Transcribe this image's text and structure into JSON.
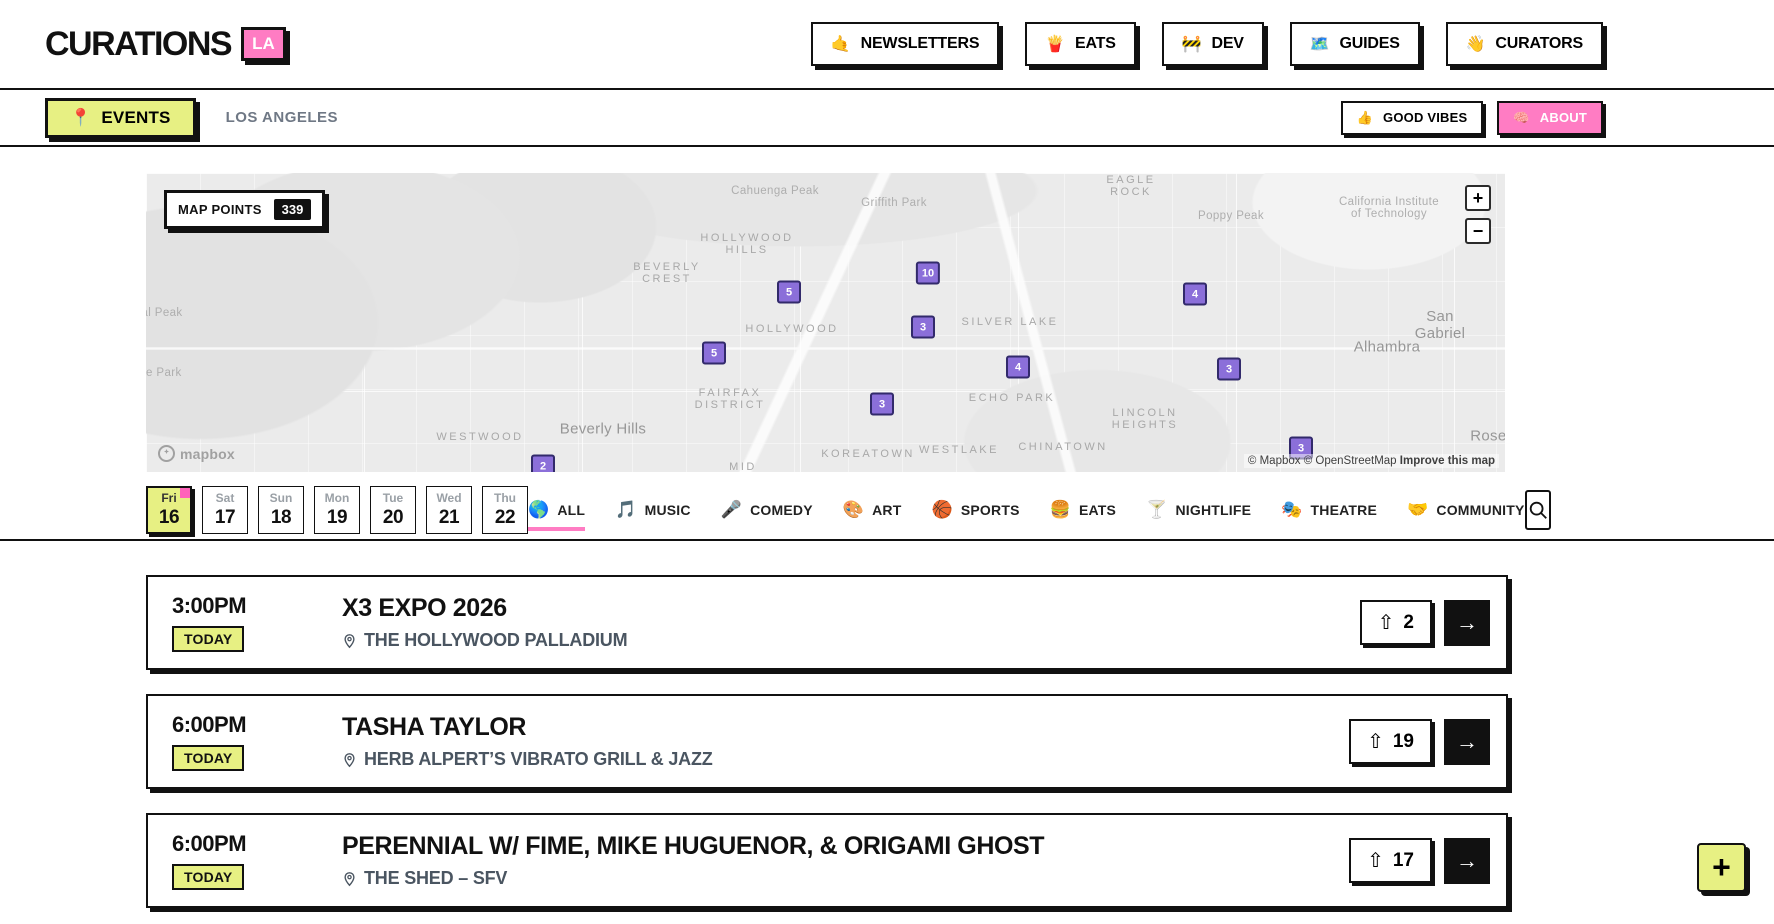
{
  "colors": {
    "pink": "#ff7cc3",
    "lime": "#e7f083",
    "purple": "#8b6fd9",
    "ink": "#111111"
  },
  "header": {
    "logo": {
      "text": "CURATIONS",
      "badge": "LA"
    },
    "nav": [
      {
        "emoji": "🤙",
        "icon_name": "call-me-hand-icon",
        "label": "NEWSLETTERS"
      },
      {
        "emoji": "🍟",
        "icon_name": "fries-icon",
        "label": "EATS"
      },
      {
        "emoji": "🚧",
        "icon_name": "construction-icon",
        "label": "DEV"
      },
      {
        "emoji": "🗺️",
        "icon_name": "world-map-icon",
        "label": "GUIDES"
      },
      {
        "emoji": "👋",
        "icon_name": "waving-hand-icon",
        "label": "CURATORS"
      }
    ]
  },
  "subheader": {
    "events_button": {
      "emoji": "📍",
      "icon_name": "pin-icon",
      "label": "EVENTS"
    },
    "location": "LOS ANGELES",
    "good_vibes_button": {
      "emoji": "👍",
      "icon_name": "thumbs-up-icon",
      "label": "GOOD VIBES"
    },
    "about_button": {
      "emoji": "🧠",
      "icon_name": "brain-icon",
      "label": "ABOUT"
    }
  },
  "map": {
    "points_label": "MAP POINTS",
    "points_count": "339",
    "zoom_in": "+",
    "zoom_out": "−",
    "logo_text": "mapbox",
    "attribution": {
      "mapbox": "© Mapbox",
      "osm": "© OpenStreetMap",
      "improve": "Improve this map"
    },
    "markers": [
      {
        "n": "5",
        "x": 643,
        "y": 119
      },
      {
        "n": "10",
        "x": 782,
        "y": 100
      },
      {
        "n": "3",
        "x": 777,
        "y": 154
      },
      {
        "n": "5",
        "x": 568,
        "y": 180
      },
      {
        "n": "4",
        "x": 872,
        "y": 194
      },
      {
        "n": "4",
        "x": 1049,
        "y": 121
      },
      {
        "n": "3",
        "x": 1083,
        "y": 196
      },
      {
        "n": "3",
        "x": 736,
        "y": 231
      },
      {
        "n": "3",
        "x": 1155,
        "y": 275
      },
      {
        "n": "2",
        "x": 397,
        "y": 293
      }
    ],
    "labels": [
      {
        "t": "Cahuenga Peak",
        "x": 629,
        "y": 18,
        "cls": "place"
      },
      {
        "t": "Griffith Park",
        "x": 748,
        "y": 30,
        "cls": "place"
      },
      {
        "t": "EAGLE\nROCK",
        "x": 985,
        "y": 13,
        "cls": "district"
      },
      {
        "t": "Poppy Peak",
        "x": 1085,
        "y": 43,
        "cls": "place"
      },
      {
        "t": "California Institute\nof Technology",
        "x": 1243,
        "y": 35,
        "cls": "place"
      },
      {
        "t": "HOLLYWOOD\nHILLS",
        "x": 601,
        "y": 71,
        "cls": "district"
      },
      {
        "t": "BEVERLY\nCREST",
        "x": 521,
        "y": 100,
        "cls": "district"
      },
      {
        "t": "HOLLYWOOD",
        "x": 646,
        "y": 156,
        "cls": "district"
      },
      {
        "t": "SILVER LAKE",
        "x": 864,
        "y": 149,
        "cls": "district"
      },
      {
        "t": "San Gabriel",
        "x": 1294,
        "y": 152,
        "cls": "city"
      },
      {
        "t": "Alhambra",
        "x": 1241,
        "y": 174,
        "cls": "city"
      },
      {
        "t": "al Peak",
        "x": 16,
        "y": 140,
        "cls": "place"
      },
      {
        "t": "te Park",
        "x": 16,
        "y": 200,
        "cls": "place"
      },
      {
        "t": "FAIRFAX\nDISTRICT",
        "x": 584,
        "y": 226,
        "cls": "district"
      },
      {
        "t": "ECHO PARK",
        "x": 866,
        "y": 225,
        "cls": "district"
      },
      {
        "t": "LINCOLN\nHEIGHTS",
        "x": 999,
        "y": 246,
        "cls": "district"
      },
      {
        "t": "Beverly Hills",
        "x": 457,
        "y": 256,
        "cls": "city"
      },
      {
        "t": "WESTWOOD",
        "x": 334,
        "y": 264,
        "cls": "district"
      },
      {
        "t": "KOREATOWN",
        "x": 722,
        "y": 281,
        "cls": "district"
      },
      {
        "t": "WESTLAKE",
        "x": 813,
        "y": 277,
        "cls": "district"
      },
      {
        "t": "CHINATOWN",
        "x": 917,
        "y": 274,
        "cls": "district"
      },
      {
        "t": "Roser",
        "x": 1345,
        "y": 263,
        "cls": "city"
      },
      {
        "t": "MID",
        "x": 597,
        "y": 294,
        "cls": "district"
      }
    ]
  },
  "filters": {
    "dates": [
      {
        "day": "Fri",
        "date": "16",
        "selected": true
      },
      {
        "day": "Sat",
        "date": "17",
        "selected": false
      },
      {
        "day": "Sun",
        "date": "18",
        "selected": false
      },
      {
        "day": "Mon",
        "date": "19",
        "selected": false
      },
      {
        "day": "Tue",
        "date": "20",
        "selected": false
      },
      {
        "day": "Wed",
        "date": "21",
        "selected": false
      },
      {
        "day": "Thu",
        "date": "22",
        "selected": false
      }
    ],
    "categories": [
      {
        "emoji": "🌎",
        "icon_name": "globe-icon",
        "label": "ALL",
        "active": true
      },
      {
        "emoji": "🎵",
        "icon_name": "music-note-icon",
        "label": "MUSIC",
        "active": false
      },
      {
        "emoji": "🎤",
        "icon_name": "microphone-icon",
        "label": "COMEDY",
        "active": false
      },
      {
        "emoji": "🎨",
        "icon_name": "palette-icon",
        "label": "ART",
        "active": false
      },
      {
        "emoji": "🏀",
        "icon_name": "basketball-icon",
        "label": "SPORTS",
        "active": false
      },
      {
        "emoji": "🍔",
        "icon_name": "burger-icon",
        "label": "EATS",
        "active": false
      },
      {
        "emoji": "🍸",
        "icon_name": "cocktail-icon",
        "label": "NIGHTLIFE",
        "active": false
      },
      {
        "emoji": "🎭",
        "icon_name": "theatre-masks-icon",
        "label": "THEATRE",
        "active": false
      },
      {
        "emoji": "🤝",
        "icon_name": "handshake-icon",
        "label": "COMMUNITY",
        "active": false
      }
    ]
  },
  "events": [
    {
      "time": "3:00PM",
      "badge": "TODAY",
      "title": "X3 EXPO 2026",
      "venue": "THE HOLLYWOOD PALLADIUM",
      "upvote_arrow": "⇧",
      "upvotes": "2",
      "go": "→"
    },
    {
      "time": "6:00PM",
      "badge": "TODAY",
      "title": "TASHA TAYLOR",
      "venue": "HERB ALPERT’S VIBRATO GRILL & JAZZ",
      "upvote_arrow": "⇧",
      "upvotes": "19",
      "go": "→"
    },
    {
      "time": "6:00PM",
      "badge": "TODAY",
      "title": "PERENNIAL W/ FIME, MIKE HUGUENOR, & ORIGAMI GHOST",
      "venue": "THE SHED – SFV",
      "upvote_arrow": "⇧",
      "upvotes": "17",
      "go": "→"
    }
  ],
  "fab": {
    "label": "+"
  }
}
